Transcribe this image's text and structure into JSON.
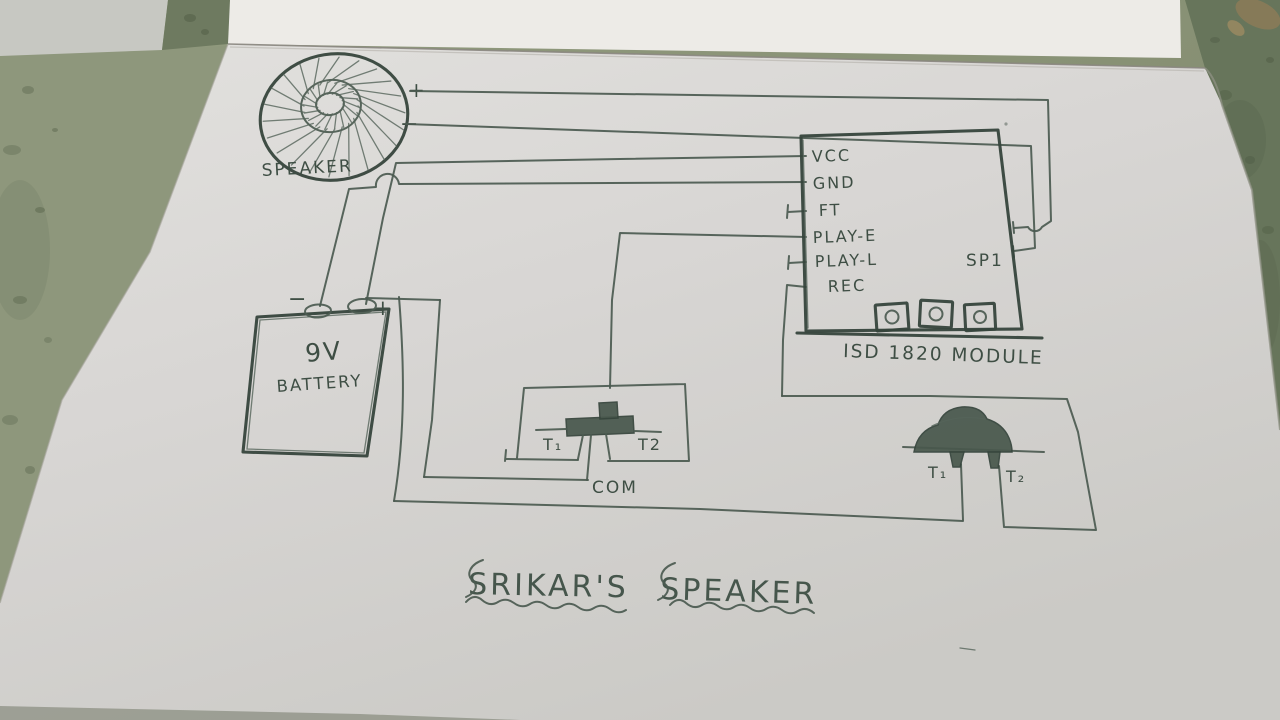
{
  "title": {
    "word1": "SRIKAR'S",
    "word2": "SPEAKER"
  },
  "speaker": {
    "label": "SPEAKER",
    "plus": "+",
    "minus": "−"
  },
  "battery": {
    "value": "9V",
    "label": "BATTERY",
    "minus": "−",
    "plus": "+"
  },
  "module": {
    "name": "ISD 1820 MODULE",
    "pins": [
      "VCC",
      "GND",
      "FT",
      "PLAY-E",
      "PLAY-L",
      "REC"
    ],
    "sp": "SP1"
  },
  "play_button": {
    "t1": "T₁",
    "t2": "T2",
    "com": "COM"
  },
  "mic": {
    "t1": "T₁",
    "t2": "T₂"
  },
  "colors": {
    "pencil": "#4b5a50",
    "paper": "#d8d6d3",
    "floor": "#8d9679"
  }
}
